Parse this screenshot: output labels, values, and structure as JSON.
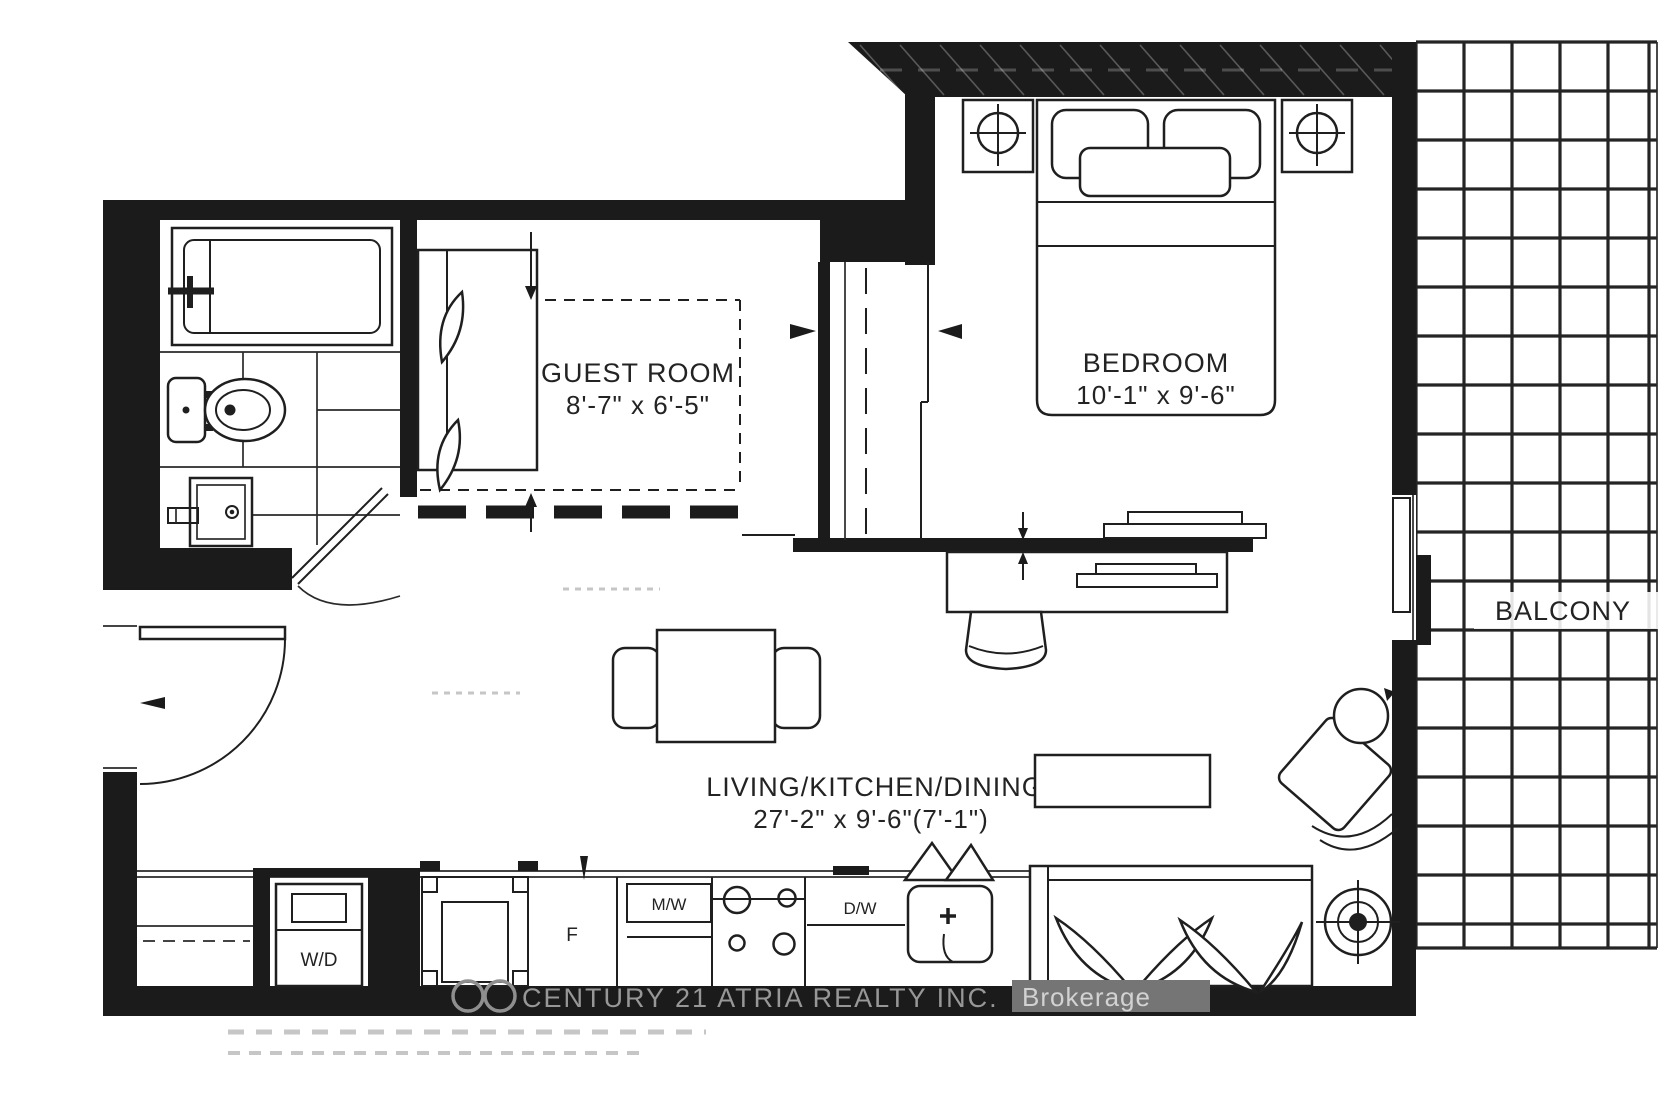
{
  "plan": {
    "rooms": {
      "guest_room": {
        "name": "GUEST ROOM",
        "dims": "8'-7\" x 6'-5\""
      },
      "bedroom": {
        "name": "BEDROOM",
        "dims": "10'-1\" x 9'-6\""
      },
      "living": {
        "name": "LIVING/KITCHEN/DINING",
        "dims": "27'-2\" x 9'-6\"(7'-1\")"
      },
      "balcony": {
        "name": "BALCONY"
      }
    },
    "appliances": {
      "washer_dryer": "W/D",
      "fridge": "F",
      "microwave": "M/W",
      "dishwasher": "D/W"
    },
    "watermark": {
      "brand": "CENTURY 21 ATRIA REALTY INC.",
      "suffix": "Brokerage"
    },
    "colors": {
      "wall": "#1b1b1b",
      "line": "#1f1f1f",
      "watermark_text": "#979797",
      "watermark_highlight": "#757575",
      "artifact": "#c6c6c6"
    }
  }
}
